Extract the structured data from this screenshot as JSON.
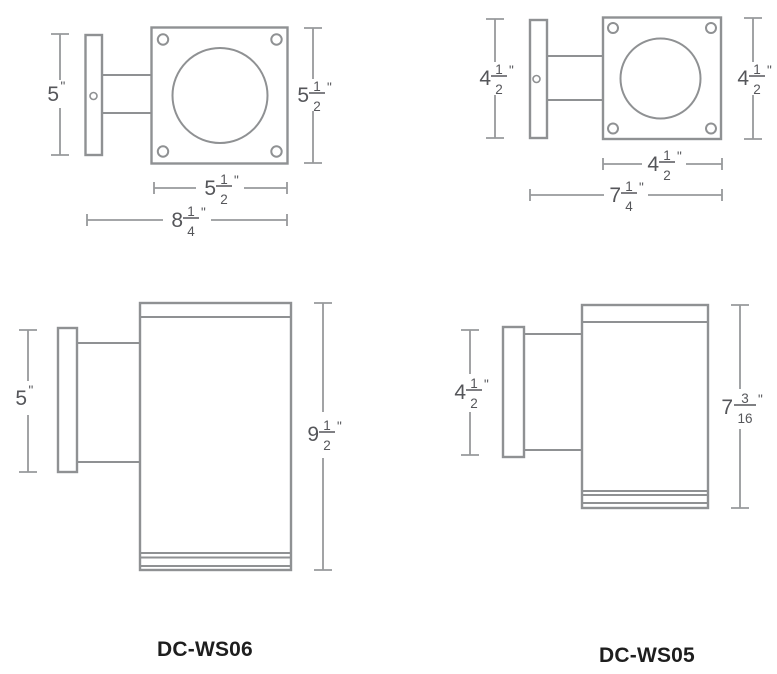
{
  "colors": {
    "background": "#ffffff",
    "fixture_line": "#8f9193",
    "dimension_line": "#97999b",
    "dimension_text": "#55565a",
    "model_text": "#1e1e1e"
  },
  "products": {
    "ws06": {
      "model": "DC-WS06",
      "top_view": {
        "backplate_height": {
          "whole": "5",
          "unit": "\""
        },
        "face_height": {
          "whole": "5",
          "num": "1",
          "den": "2",
          "unit": "\""
        },
        "face_width": {
          "whole": "5",
          "num": "1",
          "den": "2",
          "unit": "\""
        },
        "overall_depth": {
          "whole": "8",
          "num": "1",
          "den": "4",
          "unit": "\""
        }
      },
      "side_view": {
        "backplate_height": {
          "whole": "5",
          "unit": "\""
        },
        "overall_height": {
          "whole": "9",
          "num": "1",
          "den": "2",
          "unit": "\""
        }
      }
    },
    "ws05": {
      "model": "DC-WS05",
      "top_view": {
        "backplate_height": {
          "whole": "4",
          "num": "1",
          "den": "2",
          "unit": "\""
        },
        "face_height": {
          "whole": "4",
          "num": "1",
          "den": "2",
          "unit": "\""
        },
        "face_width": {
          "whole": "4",
          "num": "1",
          "den": "2",
          "unit": "\""
        },
        "overall_depth": {
          "whole": "7",
          "num": "1",
          "den": "4",
          "unit": "\""
        }
      },
      "side_view": {
        "backplate_height": {
          "whole": "4",
          "num": "1",
          "den": "2",
          "unit": "\""
        },
        "overall_height": {
          "whole": "7",
          "num": "3",
          "den": "16",
          "unit": "\""
        }
      }
    }
  }
}
